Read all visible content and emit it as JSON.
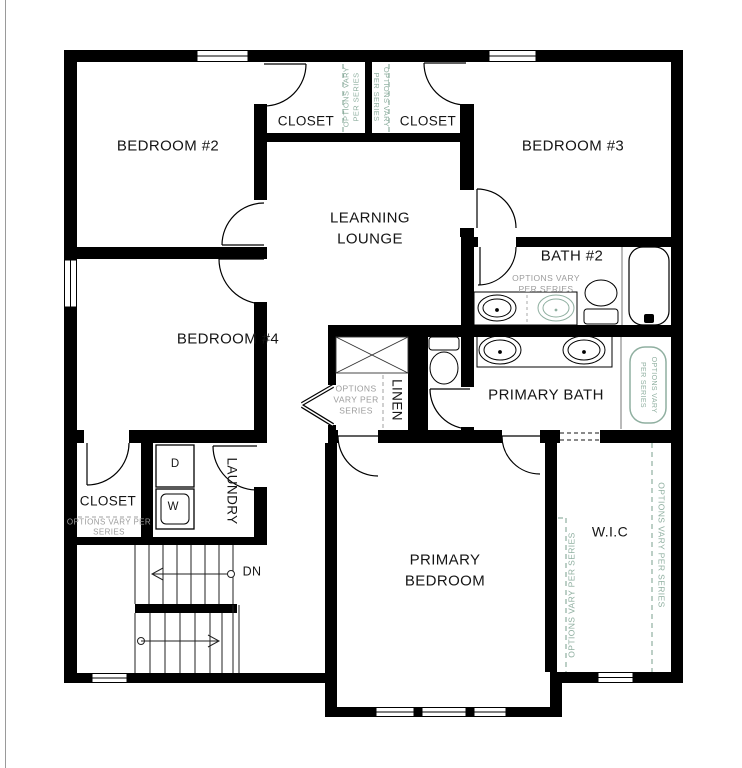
{
  "rooms": {
    "bedroom_2": "BEDROOM #2",
    "bedroom_3": "BEDROOM #3",
    "bedroom_4": "BEDROOM #4",
    "learning_lounge": "LEARNING LOUNGE",
    "bath_2": "BATH #2",
    "primary_bath": "PRIMARY BATH",
    "primary_bedroom": "PRIMARY BEDROOM",
    "wic": "W.I.C",
    "closet_top_left": "CLOSET",
    "closet_top_right": "CLOSET",
    "closet_lower_left": "CLOSET",
    "laundry": "LAUNDRY",
    "linen": "LINEN"
  },
  "annotations": {
    "options_note": "OPTIONS VARY PER SERIES",
    "stairs_down": "DN",
    "dryer": "D",
    "washer": "W"
  },
  "fixtures": [
    "bathtub",
    "optional-shower",
    "toilet",
    "toilet-water-closet",
    "bath2-vanity-sinks",
    "optional-sink",
    "primary-vanity-sinks",
    "washer",
    "dryer",
    "attic-access-x-box",
    "stairs-two-flights",
    "angled-double-doors"
  ],
  "colors": {
    "walls": "#000000",
    "optional_green": "#8fafa0",
    "note_gray": "#9c9c9c",
    "background": "#ffffff"
  }
}
